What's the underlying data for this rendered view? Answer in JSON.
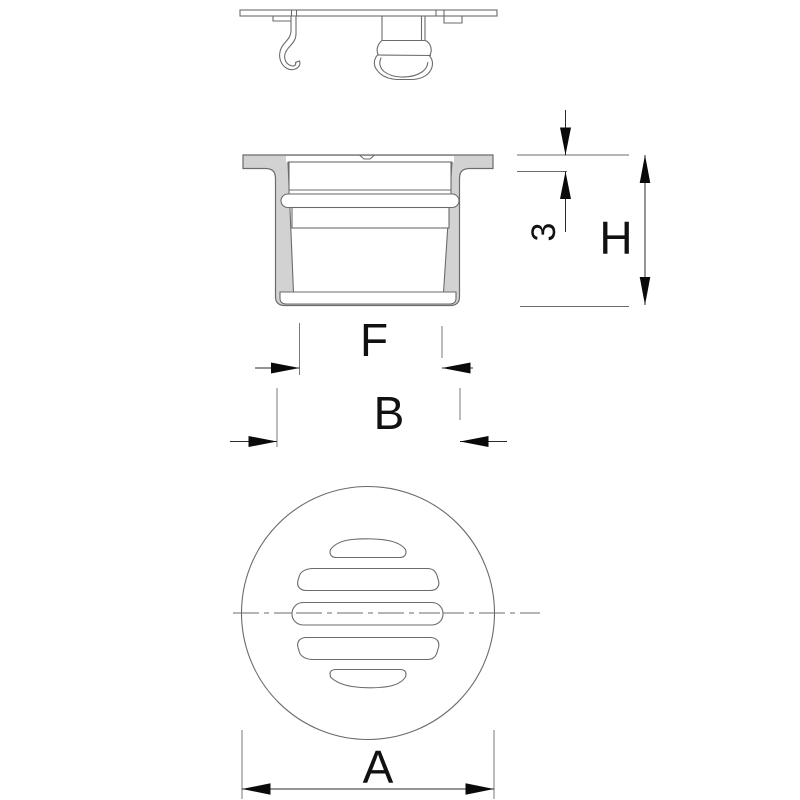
{
  "canvas": {
    "width": 800,
    "height": 800,
    "background": "#ffffff"
  },
  "labels": {
    "dim_thickness": "3",
    "dim_height": "H",
    "dim_inner_width": "F",
    "dim_body_width": "B",
    "dim_grate_diameter": "A"
  },
  "colors": {
    "section_fill": "#d2d2d2",
    "outline": "#6b6b6b",
    "dimension_line": "#2b2b2b",
    "arrow_fill": "#0a0a0a",
    "label_color": "#111111"
  }
}
